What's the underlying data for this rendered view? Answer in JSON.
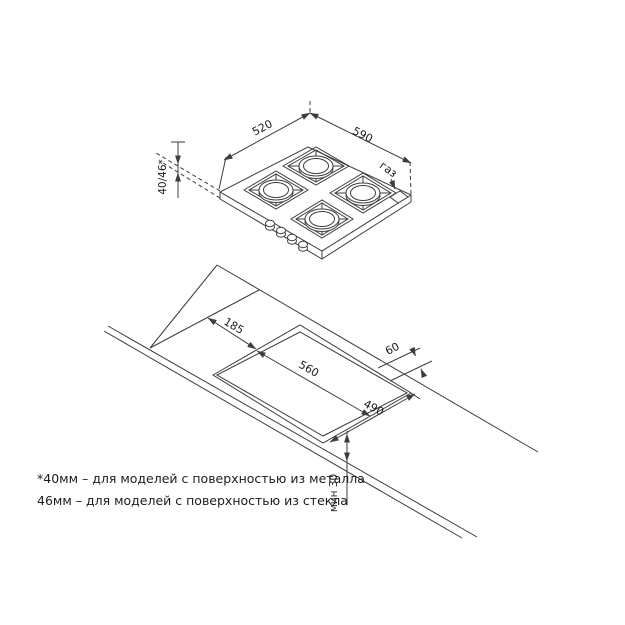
{
  "hob": {
    "dim_depth": "520",
    "dim_width": "590",
    "dim_height": "40/46*",
    "gas_label": "газ"
  },
  "cutout": {
    "dim_back_offset": "185",
    "dim_width": "560",
    "dim_right_gap": "60",
    "dim_depth": "490",
    "dim_front_min": "мин 30"
  },
  "footnote": {
    "line1": "*40мм – для моделей с поверхностью из металла",
    "line2": "46мм – для моделей с поверхностью из стекла"
  },
  "colors": {
    "line": "#3d3d3d",
    "text": "#1c1c1c",
    "background": "#ffffff"
  }
}
